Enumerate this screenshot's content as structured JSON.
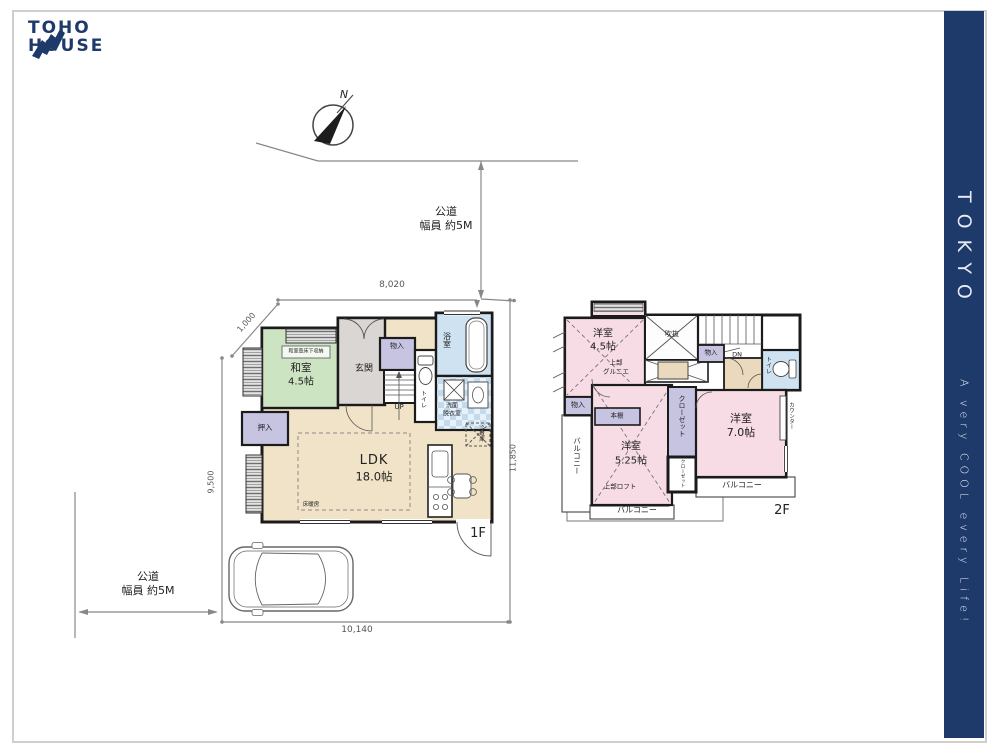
{
  "brand": {
    "line1": "TOHO",
    "line2": "HOUSE",
    "color": "#1e3a6a"
  },
  "side_banner": {
    "title": "TOKYO",
    "tagline": "A very COOL every Life!",
    "bg": "#1e3a6a"
  },
  "compass": {
    "north": "N"
  },
  "roads": {
    "top": {
      "l1": "公道",
      "l2": "幅員 約5M"
    },
    "left": {
      "l1": "公道",
      "l2": "幅員 約5M"
    }
  },
  "dimensions": {
    "top": "8,020",
    "upper_left": "1,000",
    "left": "9,500",
    "right": "11,850",
    "bottom": "10,140"
  },
  "floor1": {
    "label": "1F",
    "washitsu": {
      "name": "和室",
      "size": "4.5帖",
      "note": "和室畳床下収納"
    },
    "genkan": "玄関",
    "storage": "物入",
    "stairs_up": "UP",
    "toilet": "トイレ",
    "bath": "浴室",
    "washroom": {
      "l1": "洗面",
      "l2": "脱衣室"
    },
    "oshiire": "押入",
    "fridge": "冷蔵庫",
    "ldk": {
      "name": "LDK",
      "size": "18.0帖",
      "note": "床暖房"
    }
  },
  "floor2": {
    "label": "2F",
    "west_room": {
      "name": "洋室",
      "size": "4.5帖",
      "note1": "上部",
      "note2": "グルニエ"
    },
    "void": "吹抜",
    "stairs_dn": "DN",
    "storage_top": "物入",
    "toilet": "トイレ",
    "storage_left": "物入",
    "bookshelf": "本棚",
    "center_room": {
      "name": "洋室",
      "size": "5.25帖",
      "note": "上部ロフト"
    },
    "closet1": "クローゼット",
    "closet2": "クローゼット",
    "east_room": {
      "name": "洋室",
      "size": "7.0帖"
    },
    "counter": "カウンター",
    "balcony_left": "バルコニー",
    "balcony_bottom": "バルコニー",
    "balcony_right": "バルコニー"
  },
  "colors": {
    "wall": "#1b1b1b",
    "tatami": "#cde4c3",
    "ldk": "#f1e3c7",
    "entry": "#d9d6d3",
    "closet": "#c7c4e2",
    "wet": "#cfe2f1",
    "bedroom": "#f7dbe5",
    "hall": "#ead9bd"
  }
}
